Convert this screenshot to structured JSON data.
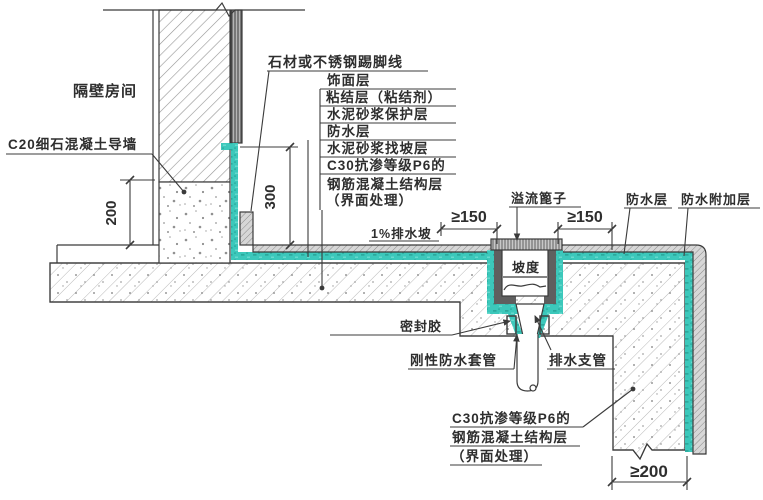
{
  "labels": {
    "adjacent_room": "隔壁房间",
    "guide_wall": "C20细石混凝土导墙",
    "skirting_title": "石材或不锈钢踢脚线",
    "layer_stack": [
      "饰面层",
      "粘结层（粘结剂）",
      "水泥砂浆保护层",
      "防水层",
      "水泥砂浆找坡层",
      "C30抗渗等级P6的",
      "钢筋混凝土结构层",
      "（界面处理）"
    ],
    "overflow_grate": "溢流篦子",
    "drain_slope": "1%排水坡",
    "waterproof_layer": "防水层",
    "waterproof_additional_layer": "防水附加层",
    "slope": "坡度",
    "sealant": "密封胶",
    "rigid_waterproof_sleeve": "刚性防水套管",
    "drain_branch_pipe": "排水支管",
    "structure_note_line1": "C30抗渗等级P6的",
    "structure_note_line2": "钢筋混凝土结构层",
    "structure_note_line3": "（界面处理）",
    "dimensions": {
      "upstand_left": "200",
      "upstand_wall": "300",
      "grate_left": "≥150",
      "grate_right": "≥150",
      "edge_width": "≥200"
    }
  },
  "colors": {
    "waterproof_teal": "#3cc8bb",
    "line": "#3b3b3b"
  }
}
